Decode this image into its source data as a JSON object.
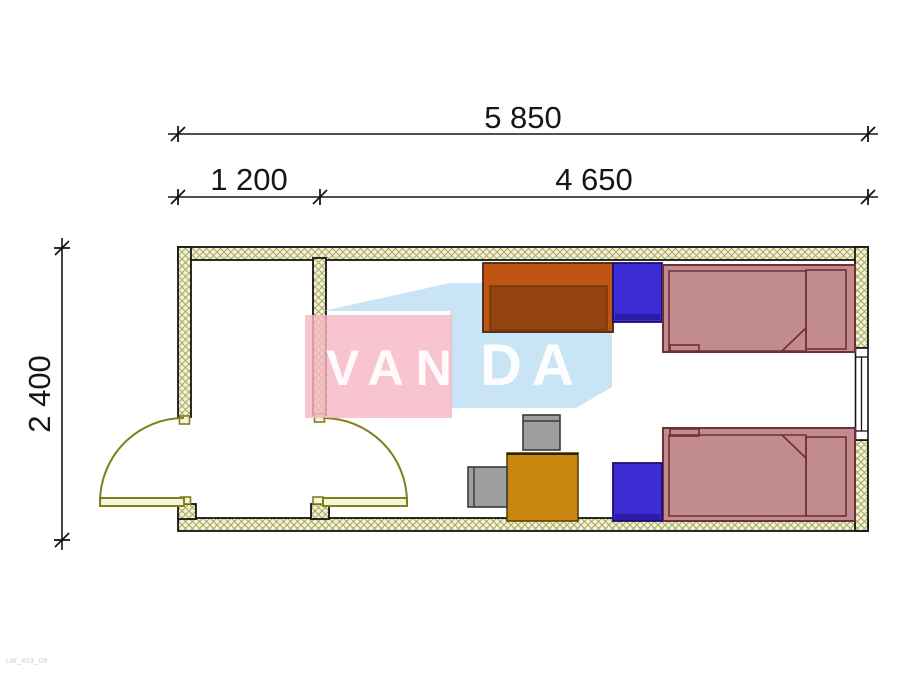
{
  "title": "Container cabin floor plan 5850 x 2400 with two beds",
  "dimensions": {
    "total_width": "5 850",
    "left_segment": "1 200",
    "right_segment": "4 650",
    "depth": "2 400"
  },
  "watermark": {
    "part1": "VAN",
    "part2": "DA",
    "pink": "#f6b7c5",
    "blue": "#b9dcf2"
  },
  "corner_note": "LW_403_08",
  "colors": {
    "wall_fill": "#f2f2dc",
    "wall_hatch": "#a8a857",
    "outline": "#141414",
    "door_olive": "#7f7f1e",
    "bed_fill": "#c28b8e",
    "bed_outline": "#6f3138",
    "nightstand_blue": "#3e2cd4",
    "wardrobe_orange": "#c05412",
    "table_gold": "#c8860f",
    "chair_gray": "#9e9e9e",
    "dimension_text": "#161616"
  },
  "furniture_icons": [
    "wardrobe",
    "nightstand",
    "single-bed",
    "pillow",
    "blanket-fold",
    "table",
    "chair",
    "entrance-door",
    "interior-door",
    "window"
  ]
}
